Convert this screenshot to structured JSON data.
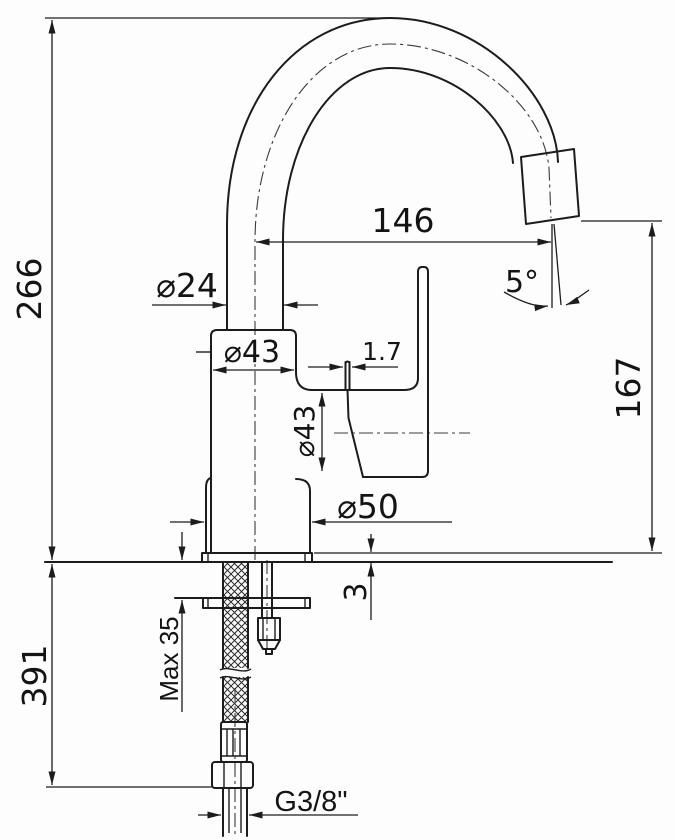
{
  "drawing": {
    "type": "faucet-technical-drawing",
    "units": "mm",
    "dimensions": {
      "height_total": "266",
      "spout_reach": "146",
      "spout_angle": "5°",
      "spout_tube_diameter": "⌀24",
      "body_diameter_top": "⌀43",
      "handle_blade_thickness": "1.7",
      "body_diameter_side": "⌀43",
      "base_diameter": "⌀50",
      "outlet_height": "167",
      "base_plate_thickness": "3",
      "max_mounting_thickness": "Max 35",
      "hose_length": "391",
      "thread_size": "G3/8\""
    },
    "line_color": "#1c1c1c",
    "background_color": "#fdfdfd"
  }
}
